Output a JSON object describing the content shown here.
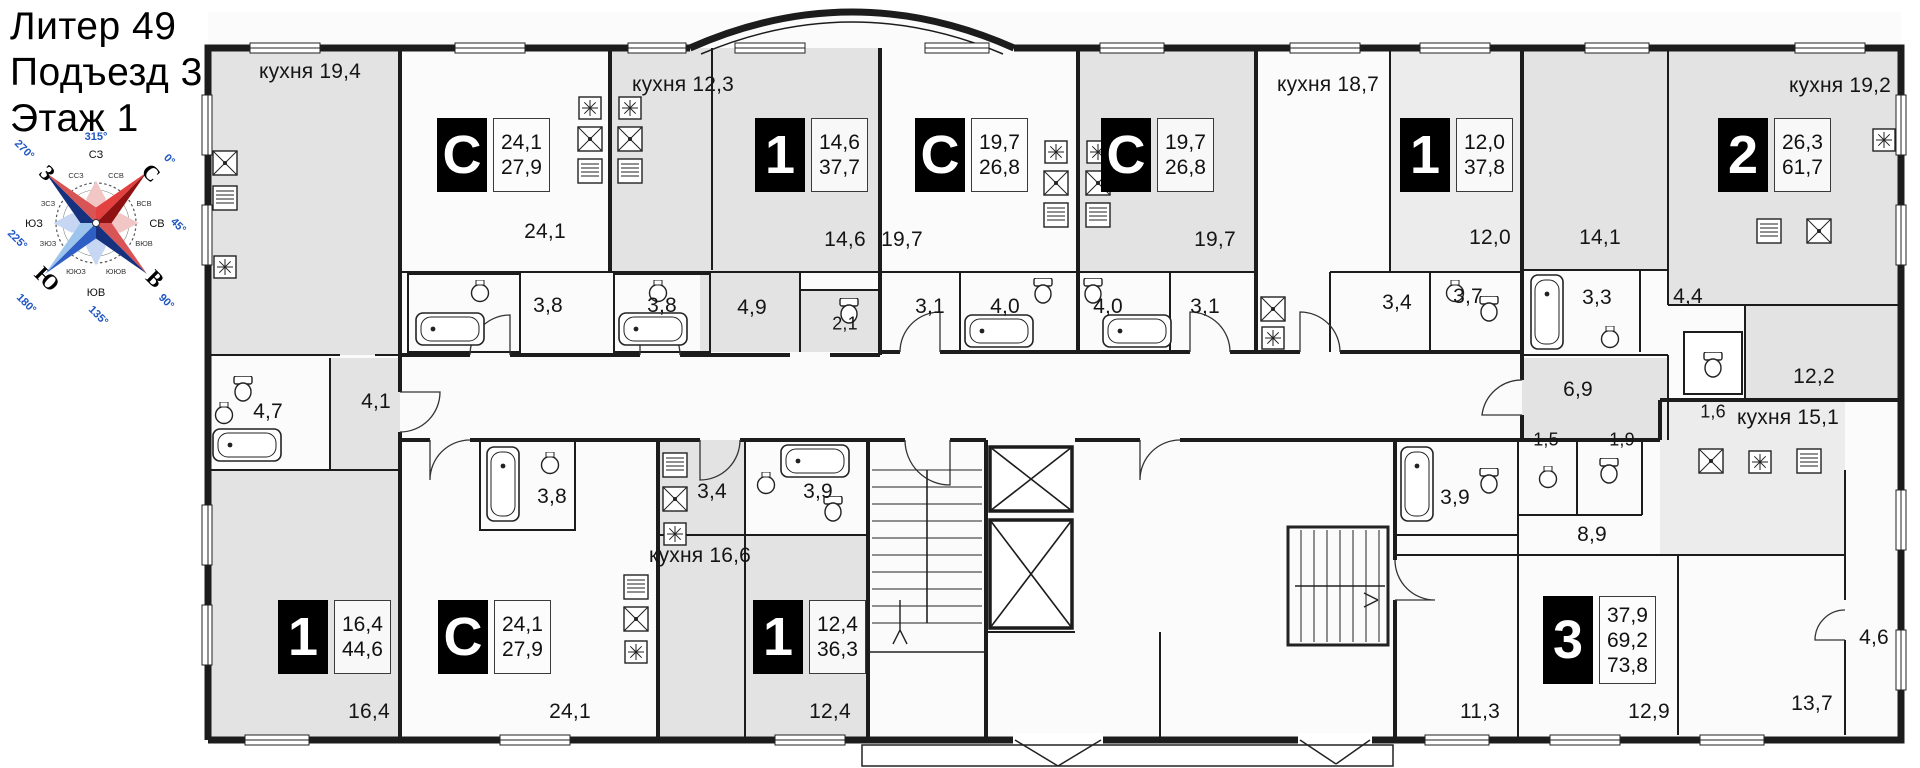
{
  "header": {
    "line1": "Литер 49",
    "line2": "Подъезд 3",
    "line3": "Этаж 1"
  },
  "compass": {
    "n": "С",
    "e": "В",
    "s": "Ю",
    "w": "З",
    "nw": "СЗ",
    "ne": "СВ",
    "se": "ЮВ",
    "sw": "ЮЗ",
    "deg0": "0°",
    "deg45": "45°",
    "deg90": "90°",
    "deg135": "135°",
    "deg180": "180°",
    "deg225": "225°",
    "deg270": "270°",
    "deg315": "315°",
    "minor": [
      "ССВ",
      "ВСВ",
      "ВЮВ",
      "ЮЮВ",
      "ЮЮЗ",
      "ЗЮЗ",
      "ЗСЗ",
      "ССЗ"
    ]
  },
  "units": [
    {
      "t": "С",
      "v1": "24,1",
      "v2": "27,9"
    },
    {
      "t": "1",
      "v1": "14,6",
      "v2": "37,7"
    },
    {
      "t": "С",
      "v1": "19,7",
      "v2": "26,8"
    },
    {
      "t": "С",
      "v1": "19,7",
      "v2": "26,8"
    },
    {
      "t": "1",
      "v1": "12,0",
      "v2": "37,8"
    },
    {
      "t": "2",
      "v1": "26,3",
      "v2": "61,7"
    },
    {
      "t": "1",
      "v1": "16,4",
      "v2": "44,6"
    },
    {
      "t": "С",
      "v1": "24,1",
      "v2": "27,9"
    },
    {
      "t": "1",
      "v1": "12,4",
      "v2": "36,3"
    },
    {
      "t": "3",
      "v1": "37,9",
      "v2": "69,2",
      "v3": "73,8"
    }
  ],
  "labels": {
    "k19_4": "кухня 19,4",
    "k12_3": "кухня 12,3",
    "k18_7": "кухня 18,7",
    "k19_2": "кухня 19,2",
    "k16_6": "кухня 16,6",
    "k15_1": "кухня 15,1",
    "a24_1": "24,1",
    "a3_8a": "3,8",
    "a3_8b": "3,8",
    "a4_9": "4,9",
    "a2_1": "2,1",
    "a14_6": "14,6",
    "a19_7a": "19,7",
    "a3_1a": "3,1",
    "a4_0a": "4,0",
    "a4_0b": "4,0",
    "a3_1b": "3,1",
    "a19_7b": "19,7",
    "a3_4t": "3,4",
    "a3_7": "3,7",
    "a12_0": "12,0",
    "a14_1": "14,1",
    "a3_3": "3,3",
    "a4_4": "4,4",
    "a1_6": "1,6",
    "a6_9": "6,9",
    "a12_2": "12,2",
    "a4_7": "4,7",
    "a4_1": "4,1",
    "a3_8c": "3,8",
    "a3_4b": "3,4",
    "a3_9a": "3,9",
    "a16_4": "16,4",
    "a24_1b": "24,1",
    "a12_4": "12,4",
    "a1_5": "1,5",
    "a1_9": "1,9",
    "a8_9": "8,9",
    "a3_9b": "3,9",
    "a11_3": "11,3",
    "a12_9": "12,9",
    "a13_7": "13,7",
    "a4_6": "4,6"
  }
}
